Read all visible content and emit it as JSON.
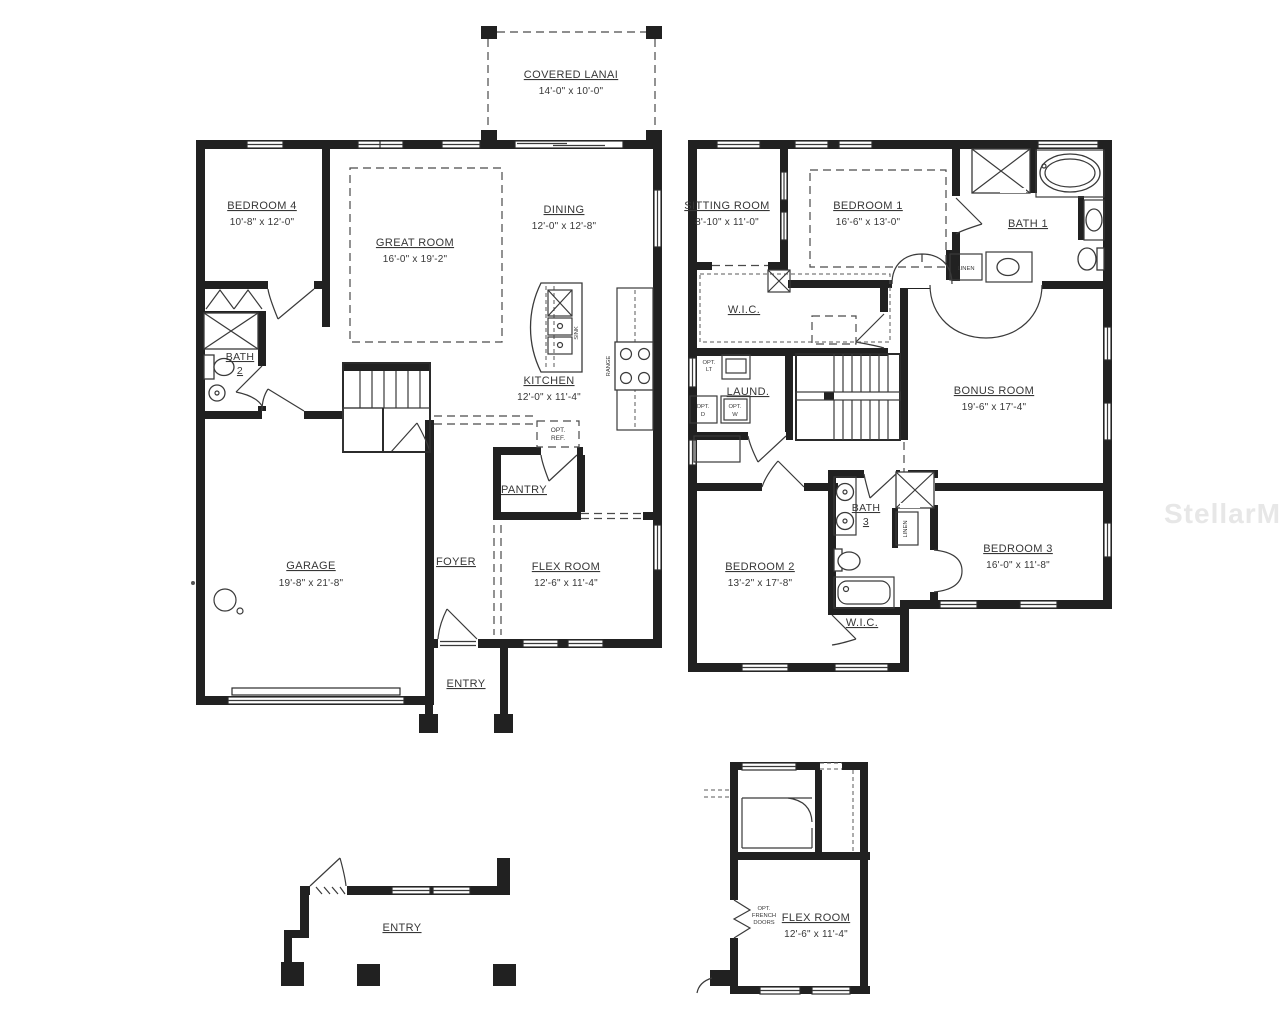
{
  "watermark": "StellarMLS",
  "first_floor": {
    "covered_lanai": {
      "name": "COVERED LANAI",
      "dims": "14'-0\" x 10'-0\""
    },
    "bedroom_4": {
      "name": "BEDROOM 4",
      "dims": "10'-8\" x 12'-0\""
    },
    "great_room": {
      "name": "GREAT ROOM",
      "dims": "16'-0\" x 19'-2\""
    },
    "dining": {
      "name": "DINING",
      "dims": "12'-0\" x 12'-8\""
    },
    "bath_2": {
      "name": "BATH",
      "number": "2"
    },
    "kitchen": {
      "name": "KITCHEN",
      "dims": "12'-0\" x 11'-4\""
    },
    "pantry": {
      "name": "PANTRY"
    },
    "foyer": {
      "name": "FOYER"
    },
    "garage": {
      "name": "GARAGE",
      "dims": "19'-8\" x 21'-8\""
    },
    "flex_room": {
      "name": "FLEX ROOM",
      "dims": "12'-6\" x 11'-4\""
    },
    "entry": {
      "name": "ENTRY"
    },
    "sink_label": "SINK",
    "range_label": "RANGE",
    "opt_ref": {
      "l1": "OPT.",
      "l2": "REF."
    }
  },
  "second_floor": {
    "sitting_room": {
      "name": "SITTING ROOM",
      "dims": "8'-10\" x 11'-0\""
    },
    "bedroom_1": {
      "name": "BEDROOM 1",
      "dims": "16'-6\" x 13'-0\""
    },
    "bath_1": {
      "name": "BATH 1"
    },
    "linen_1": "LINEN",
    "wic_1": "W.I.C.",
    "laundry": {
      "name": "LAUND."
    },
    "opt_lt": {
      "l1": "OPT.",
      "l2": "LT"
    },
    "opt_d": {
      "l1": "OPT.",
      "l2": "D"
    },
    "opt_w": {
      "l1": "OPT.",
      "l2": "W"
    },
    "bonus_room": {
      "name": "BONUS ROOM",
      "dims": "19'-6\" x 17'-4\""
    },
    "bedroom_2": {
      "name": "BEDROOM 2",
      "dims": "13'-2\" x 17'-8\""
    },
    "bath_3": {
      "name": "BATH",
      "number": "3"
    },
    "linen_2": "LINEN",
    "wic_2": "W.I.C.",
    "bedroom_3": {
      "name": "BEDROOM 3",
      "dims": "16'-0\" x 11'-8\""
    }
  },
  "entry_detail": {
    "name": "ENTRY"
  },
  "flex_room_detail": {
    "name": "FLEX ROOM",
    "dims": "12'-6\" x 11'-4\"",
    "opt_french_doors": {
      "l1": "OPT.",
      "l2": "FRENCH",
      "l3": "DOORS"
    }
  }
}
